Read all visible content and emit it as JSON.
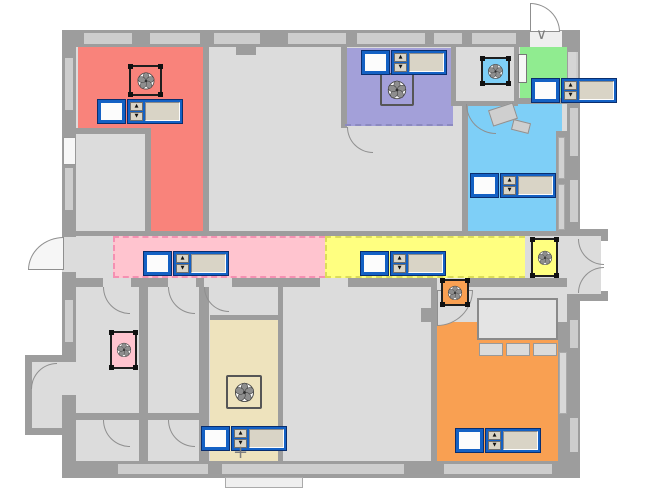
{
  "palette": {
    "floor": "#DCDCDC",
    "wall": "#9D9D9D",
    "window": "#CDCDCD",
    "outside": "#FFFFFF",
    "door_line": "#8F8F8F",
    "widget_blue": "#1461C4",
    "widget_navy": "#0A2E6E",
    "widget_face": "#D9D4C6",
    "fan_frame": "#1F1F1F",
    "fan_blade": "#8E8E8E"
  },
  "zones": [
    {
      "name": "zone-salmon-upper",
      "color": "#F9837B",
      "rect": [
        78,
        47,
        125,
        83
      ]
    },
    {
      "name": "zone-salmon-wing",
      "color": "#F9837B",
      "rect": [
        151,
        128,
        52,
        103
      ]
    },
    {
      "name": "zone-purple",
      "color": "#A3A0D9",
      "rect": [
        345,
        48,
        108,
        78
      ]
    },
    {
      "name": "zone-green",
      "color": "#90EC90",
      "rect": [
        520,
        42,
        48,
        58
      ]
    },
    {
      "name": "zone-cyan",
      "color": "#7ECFF7",
      "rect": [
        468,
        104,
        94,
        127
      ]
    },
    {
      "name": "zone-pink-corridor",
      "color": "#FFC4CF",
      "rect": [
        113,
        236,
        212,
        42
      ],
      "dash": "#F590B2"
    },
    {
      "name": "zone-yellow-corridor",
      "color": "#FFFF80",
      "rect": [
        325,
        236,
        200,
        42
      ],
      "dash": "#DCDC5A"
    },
    {
      "name": "zone-beige",
      "color": "#EEE3BD",
      "rect": [
        210,
        320,
        68,
        142
      ]
    },
    {
      "name": "zone-orange",
      "color": "#F9A052",
      "rect": [
        437,
        322,
        121,
        140
      ]
    }
  ],
  "underlays": [
    {
      "name": "main-floor",
      "rect": [
        76,
        47,
        491,
        415
      ]
    }
  ],
  "vestibules": [
    {
      "name": "left-vestibule",
      "rect": [
        25,
        355,
        44,
        80
      ]
    }
  ],
  "walls": [
    [
      62,
      30,
      518,
      17
    ],
    [
      62,
      30,
      14,
      448
    ],
    [
      62,
      461,
      518,
      17
    ],
    [
      567,
      30,
      13,
      448
    ],
    [
      76,
      128,
      75,
      6
    ],
    [
      145,
      128,
      6,
      108
    ],
    [
      203,
      47,
      6,
      189
    ],
    [
      341,
      47,
      6,
      81
    ],
    [
      451,
      47,
      5,
      58
    ],
    [
      514,
      42,
      5,
      62
    ],
    [
      514,
      98,
      54,
      6
    ],
    [
      451,
      101,
      67,
      5
    ],
    [
      462,
      101,
      6,
      135
    ],
    [
      76,
      231,
      491,
      5
    ],
    [
      76,
      278,
      491,
      9
    ],
    [
      139,
      287,
      9,
      126
    ],
    [
      76,
      413,
      129,
      7
    ],
    [
      139,
      420,
      9,
      42
    ],
    [
      199,
      287,
      10,
      175
    ],
    [
      210,
      315,
      68,
      5
    ],
    [
      278,
      287,
      5,
      175
    ],
    [
      431,
      287,
      6,
      175
    ],
    [
      556,
      131,
      11,
      105
    ],
    [
      558,
      322,
      9,
      140
    ],
    [
      575,
      229,
      33,
      7
    ],
    [
      575,
      294,
      33,
      7
    ],
    [
      601,
      229,
      7,
      12
    ],
    [
      601,
      291,
      7,
      10
    ]
  ],
  "wall_gaps": [
    {
      "rect": [
        530,
        31,
        32,
        16
      ],
      "color": "#EFEFEF"
    },
    {
      "rect": [
        62,
        237,
        14,
        35
      ]
    },
    {
      "rect": [
        62,
        362,
        14,
        33
      ]
    },
    {
      "rect": [
        103,
        278,
        28,
        9
      ]
    },
    {
      "rect": [
        168,
        278,
        28,
        9
      ]
    },
    {
      "rect": [
        204,
        278,
        28,
        9
      ]
    },
    {
      "rect": [
        320,
        278,
        28,
        9
      ]
    },
    {
      "rect": [
        437,
        278,
        30,
        9
      ]
    },
    {
      "rect": [
        567,
        236,
        34,
        58
      ]
    }
  ],
  "windows": [
    [
      84,
      33,
      48,
      11
    ],
    [
      150,
      33,
      50,
      11
    ],
    [
      214,
      33,
      46,
      11
    ],
    [
      288,
      33,
      58,
      11
    ],
    [
      357,
      33,
      68,
      11
    ],
    [
      434,
      33,
      28,
      11
    ],
    [
      472,
      33,
      44,
      11
    ],
    [
      65,
      58,
      8,
      52
    ],
    [
      65,
      168,
      8,
      42
    ],
    [
      65,
      300,
      8,
      42
    ],
    [
      570,
      52,
      8,
      40
    ],
    [
      570,
      108,
      8,
      48
    ],
    [
      570,
      180,
      8,
      42
    ],
    [
      570,
      320,
      8,
      28
    ],
    [
      570,
      418,
      8,
      34
    ],
    [
      118,
      464,
      90,
      10
    ],
    [
      222,
      464,
      182,
      10
    ],
    [
      444,
      464,
      108,
      10
    ]
  ],
  "doors": [
    {
      "name": "door-exterior-top",
      "rect": [
        530,
        3,
        30,
        29
      ],
      "corner": "tr",
      "fill": "#FFFFFF"
    },
    {
      "name": "door-exterior-west",
      "rect": [
        28,
        237,
        36,
        33
      ],
      "corner": "tl",
      "fill": "#F6F6F6"
    },
    {
      "name": "door-orange-room",
      "rect": [
        437,
        290,
        36,
        36
      ],
      "corner": "br",
      "fill": "#DCDCDC"
    },
    {
      "name": "door-purple-room",
      "rect": [
        347,
        127,
        26,
        26
      ],
      "corner": "bl"
    },
    {
      "name": "door-cyan-room",
      "rect": [
        466,
        104,
        30,
        30
      ],
      "corner": "bl"
    },
    {
      "name": "door-vestibule",
      "rect": [
        31,
        363,
        26,
        26
      ],
      "corner": "tl"
    },
    {
      "name": "door-room-b1",
      "rect": [
        103,
        287,
        27,
        27
      ],
      "corner": "bl"
    },
    {
      "name": "door-room-b2",
      "rect": [
        168,
        287,
        27,
        27
      ],
      "corner": "bl"
    },
    {
      "name": "door-room-b3",
      "rect": [
        103,
        420,
        27,
        27
      ],
      "corner": "bl"
    },
    {
      "name": "door-room-b4",
      "rect": [
        168,
        420,
        27,
        27
      ],
      "corner": "bl"
    },
    {
      "name": "door-storage-room",
      "rect": [
        204,
        287,
        25,
        25
      ],
      "corner": "bl"
    },
    {
      "name": "door-double-top",
      "rect": [
        578,
        239,
        26,
        26
      ],
      "corner": "bl"
    },
    {
      "name": "door-double-bottom",
      "rect": [
        578,
        267,
        26,
        26
      ],
      "corner": "tl"
    }
  ],
  "fixtures": [
    {
      "name": "wall-niche-left",
      "rect": [
        63,
        137,
        13,
        28
      ],
      "bg": "#F7F7F7",
      "border": "#999999"
    },
    {
      "name": "green-room-door-leaf",
      "rect": [
        518,
        54,
        9,
        29
      ],
      "bg": "#F7F7F7",
      "border": "#777777"
    },
    {
      "name": "wall-tab-top",
      "rect": [
        236,
        47,
        20,
        8
      ],
      "bg": "#9D9D9D"
    },
    {
      "name": "wall-tab-bigroom",
      "rect": [
        421,
        308,
        12,
        14
      ],
      "bg": "#9D9D9D"
    },
    {
      "name": "table",
      "rect": [
        477,
        298,
        81,
        42
      ],
      "bg": "#E4E4E4",
      "border": "#8A8A8A",
      "bw": 2
    },
    {
      "name": "chair",
      "rect": [
        479,
        343,
        24,
        13
      ],
      "bg": "#DBDBDB",
      "border": "#999999"
    },
    {
      "name": "chair",
      "rect": [
        506,
        343,
        24,
        13
      ],
      "bg": "#DBDBDB",
      "border": "#999999"
    },
    {
      "name": "chair",
      "rect": [
        533,
        343,
        24,
        13
      ],
      "bg": "#DBDBDB",
      "border": "#999999"
    },
    {
      "name": "closet-shelf",
      "rect": [
        558,
        137,
        7,
        42
      ],
      "bg": "#D2D2D2",
      "border": "#AAAAAA"
    },
    {
      "name": "closet-shelf",
      "rect": [
        558,
        184,
        7,
        46
      ],
      "bg": "#D2D2D2",
      "border": "#AAAAAA"
    },
    {
      "name": "wall-niche-right",
      "rect": [
        559,
        352,
        8,
        62
      ],
      "bg": "#D8D8D8",
      "border": "#AAAAAA"
    },
    {
      "name": "stair-landing",
      "rect": [
        490,
        106,
        26,
        17
      ],
      "bg": "#CFCFCF",
      "border": "#909090",
      "rot": -18
    },
    {
      "name": "stair-landing",
      "rect": [
        512,
        121,
        18,
        11
      ],
      "bg": "#CFCFCF",
      "border": "#909090",
      "rot": 14
    },
    {
      "name": "exterior-step",
      "rect": [
        225,
        477,
        78,
        11
      ],
      "bg": "#EFEFEF",
      "border": "#AAAAAA"
    },
    {
      "name": "window-tab-green",
      "rect": [
        568,
        52,
        8,
        28
      ],
      "bg": "#D5D5D5"
    },
    {
      "name": "purple-zone-dashed-edge",
      "rect": [
        345,
        124,
        108,
        2
      ],
      "dash": "#8C8AC0"
    }
  ],
  "fans": [
    {
      "name": "fan-unit-salmon-room",
      "color": "#F9837B",
      "rect": [
        129,
        65,
        33,
        31
      ],
      "style": "brackets"
    },
    {
      "name": "fan-unit-purple-room",
      "color": "#A3A0D9",
      "rect": [
        380,
        73,
        34,
        33
      ],
      "style": "plain"
    },
    {
      "name": "fan-unit-cyan-zone",
      "color": "#7ECFF7",
      "rect": [
        481,
        57,
        29,
        28
      ],
      "style": "brackets"
    },
    {
      "name": "fan-unit-pink-zone",
      "color": "#FFC4CF",
      "rect": [
        110,
        331,
        27,
        38
      ],
      "style": "brackets"
    },
    {
      "name": "fan-unit-beige-room",
      "color": "#EEE3BD",
      "rect": [
        226,
        375,
        36,
        34
      ],
      "style": "plain"
    },
    {
      "name": "fan-unit-yellow-zone",
      "color": "#FFFF80",
      "rect": [
        531,
        238,
        27,
        39
      ],
      "style": "brackets"
    },
    {
      "name": "fan-unit-orange-room",
      "color": "#F9A052",
      "rect": [
        441,
        279,
        28,
        27
      ],
      "style": "brackets"
    }
  ],
  "controls": [
    {
      "name": "hvac-control-salmon-room",
      "pos": [
        98,
        100
      ]
    },
    {
      "name": "hvac-control-purple-room",
      "pos": [
        362,
        51
      ]
    },
    {
      "name": "hvac-control-green-room",
      "pos": [
        532,
        79
      ]
    },
    {
      "name": "hvac-control-cyan-room",
      "pos": [
        471,
        174
      ]
    },
    {
      "name": "hvac-control-pink-corridor",
      "pos": [
        144,
        252
      ]
    },
    {
      "name": "hvac-control-yellow-corridor",
      "pos": [
        361,
        252
      ]
    },
    {
      "name": "hvac-control-beige-room",
      "pos": [
        202,
        427
      ]
    },
    {
      "name": "hvac-control-orange-room",
      "pos": [
        456,
        429
      ]
    }
  ],
  "widget": {
    "up_glyph": "▲",
    "down_glyph": "▼",
    "checkbox_value": "",
    "field_value": ""
  },
  "glyph_marks": [
    {
      "name": "entry-arrow",
      "glyph": "∨",
      "pos": [
        536,
        27
      ],
      "size": 15
    },
    {
      "name": "survey-mark",
      "glyph": "+",
      "pos": [
        233,
        444
      ],
      "size": 18
    }
  ]
}
